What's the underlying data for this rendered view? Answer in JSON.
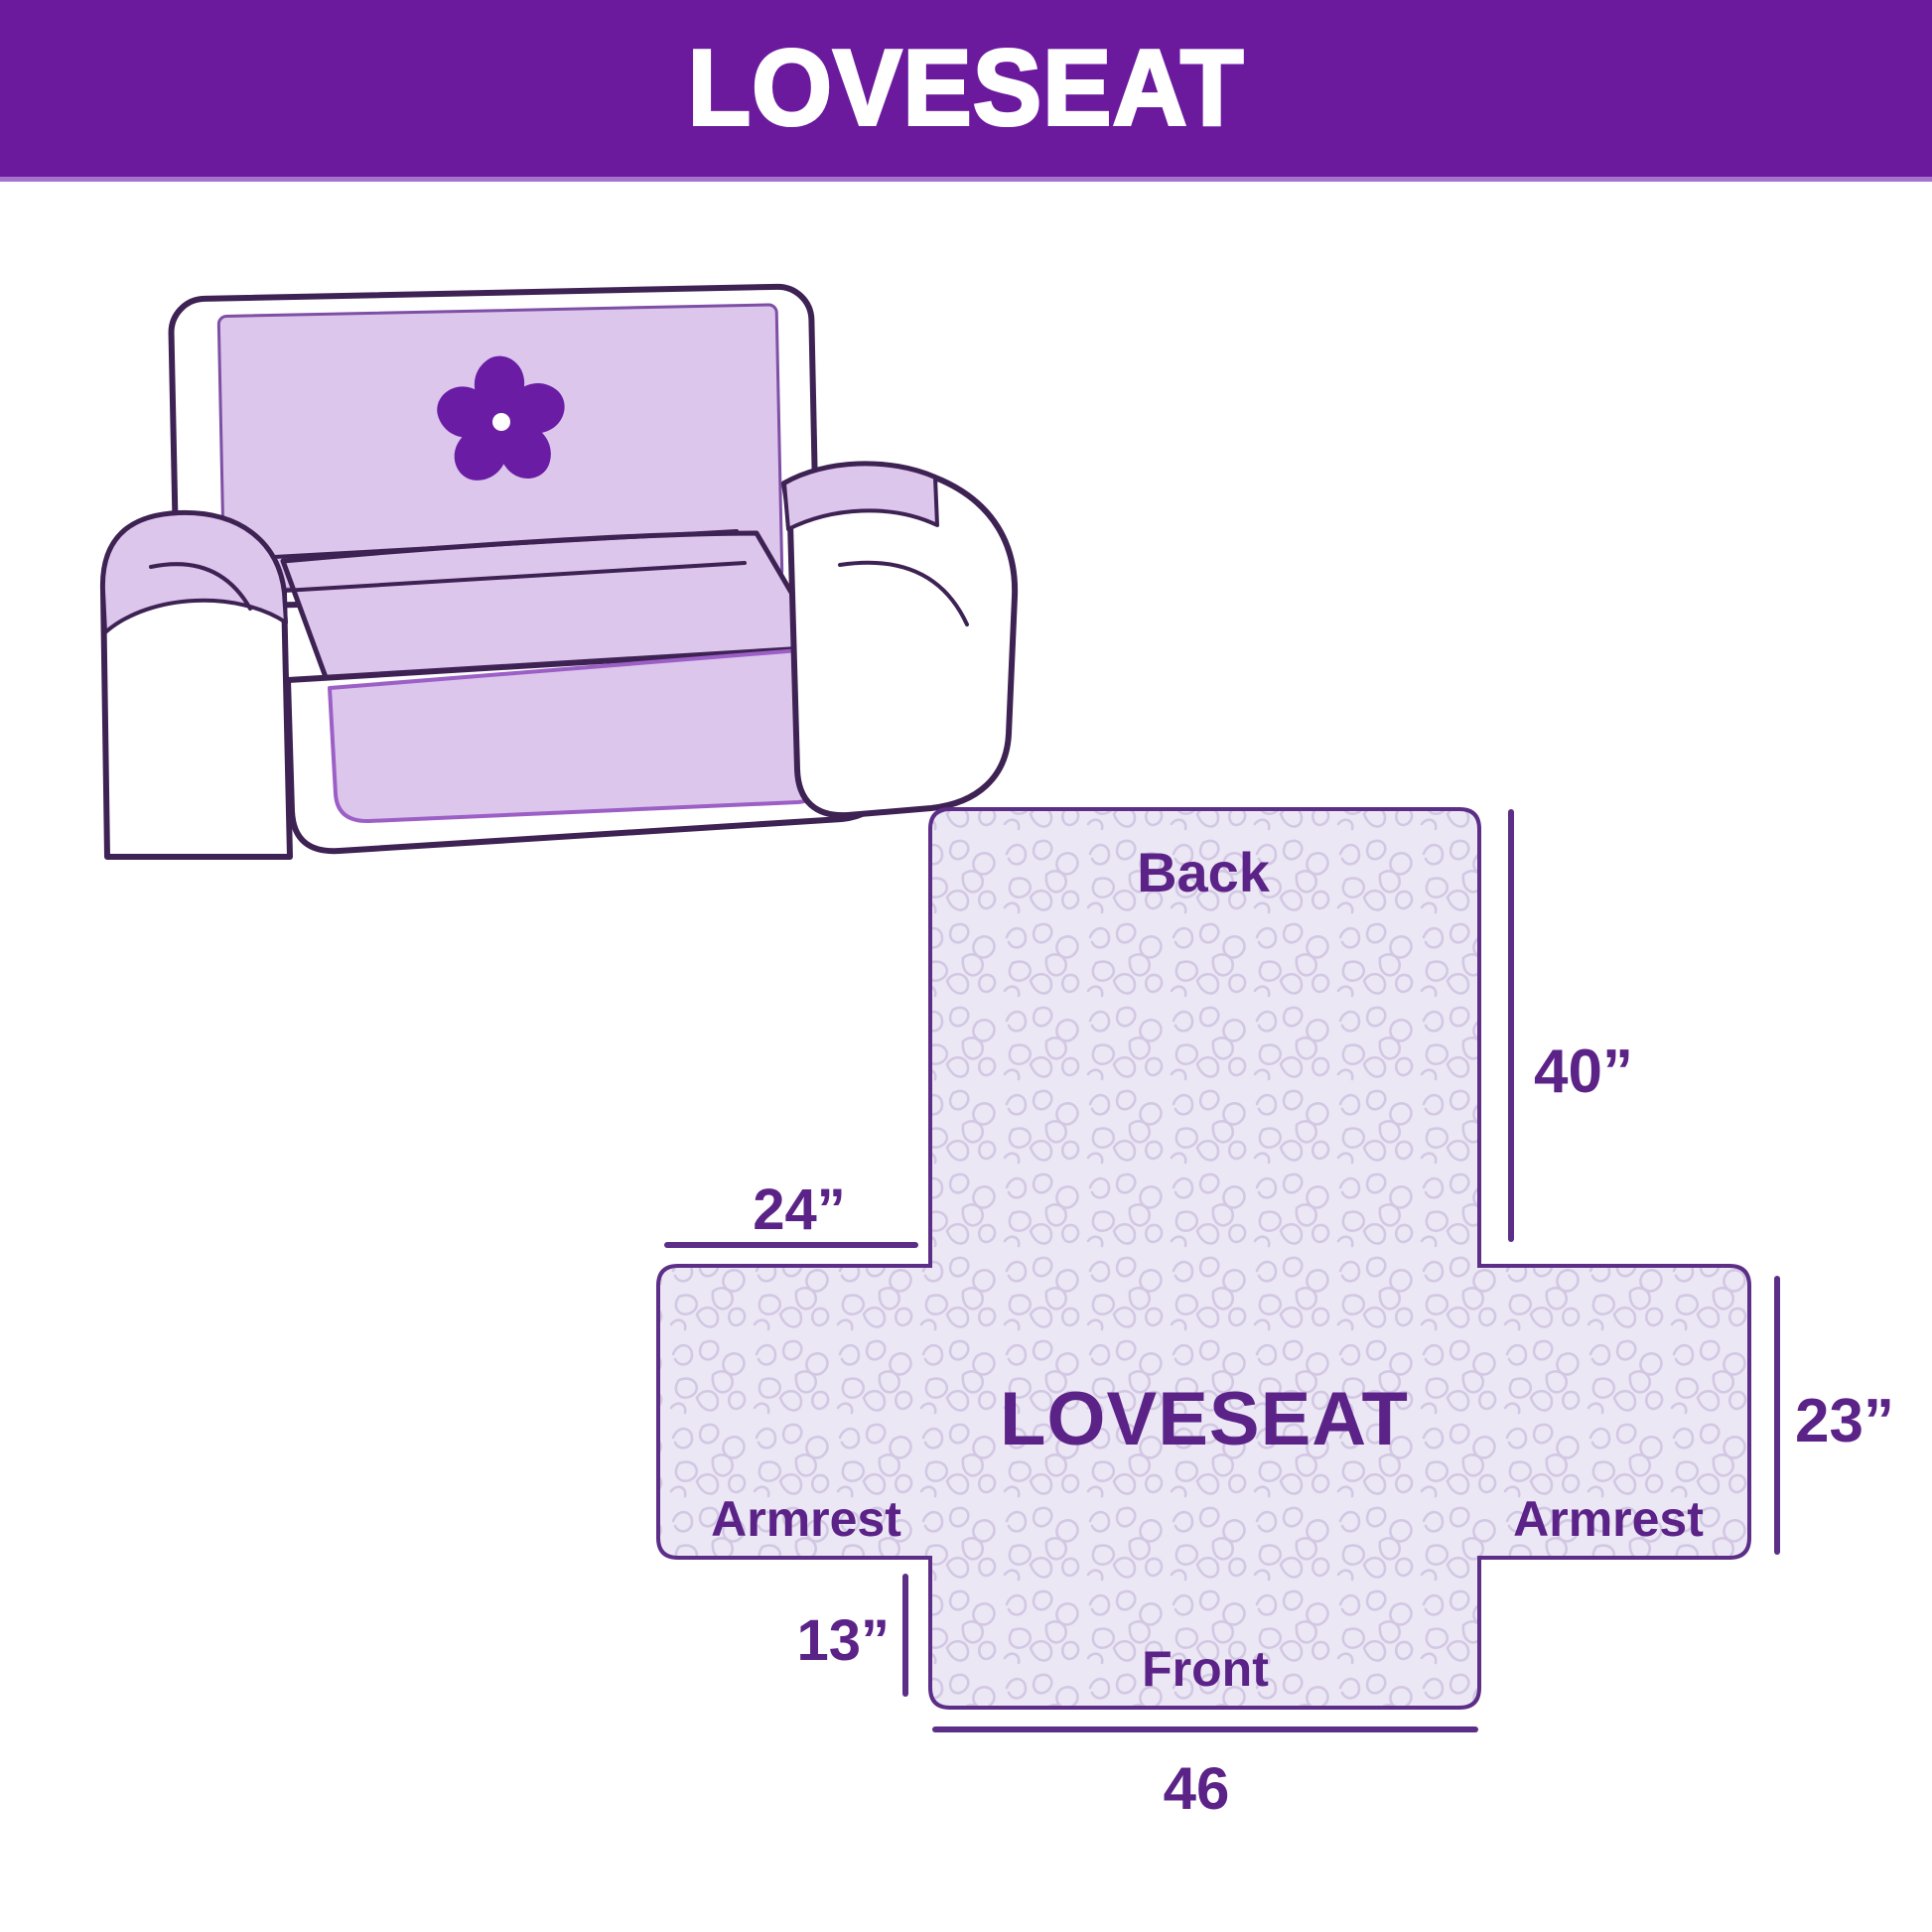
{
  "header": {
    "title": "LOVESEAT"
  },
  "illustration": {
    "description": "loveseat sofa with lavender slipcover and pinwheel logo",
    "logo_icon": "pinwheel"
  },
  "diagram": {
    "center_label": "LOVESEAT",
    "back_label": "Back",
    "front_label": "Front",
    "armrest_left_label": "Armrest",
    "armrest_right_label": "Armrest",
    "dim_back_height": "40”",
    "dim_armrest_width": "24”",
    "dim_side_height": "23”",
    "dim_front_drop": "13”",
    "dim_front_width": "46"
  },
  "colors": {
    "banner_bg": "#6b1a9e",
    "banner_text": "#ffffff",
    "label_text": "#5b2387",
    "dimension_line": "#5c2e87",
    "diagram_fill": "#ece7f4",
    "quilt_pattern": "#d3c8e4",
    "diagram_outline": "#5c2e87",
    "sofa_outline": "#3d2253",
    "cover_lavender": "#dcc6ec",
    "cover_edge": "#9c5fc6",
    "pinwheel": "#6a1ca4"
  }
}
